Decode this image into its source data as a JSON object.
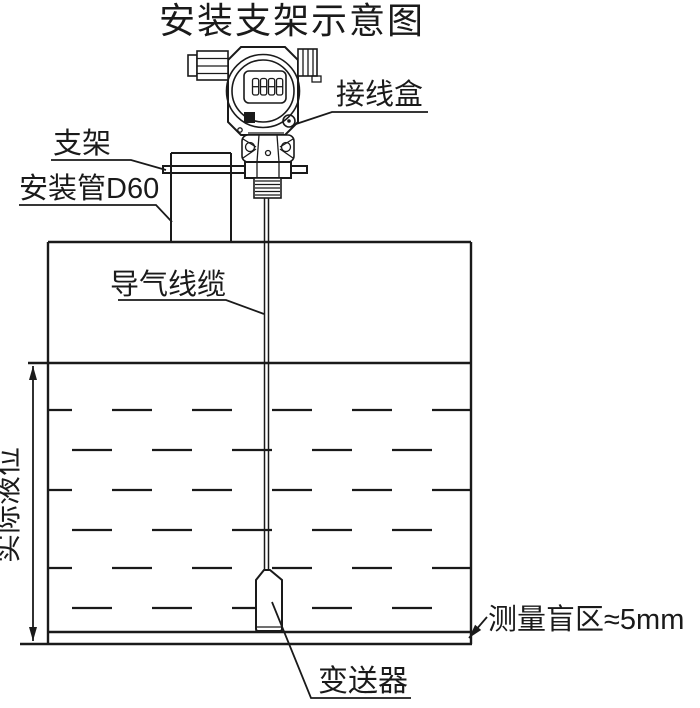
{
  "title": "安装支架示意图",
  "labels": {
    "junction_box": "接线盒",
    "bracket": "支架",
    "mounting_pipe": "安装管D60",
    "air_cable": "导气线缆",
    "actual_level": "实际液位",
    "transmitter": "变送器",
    "blind_zone": "测量盲区≈5mm"
  },
  "lcd": {
    "value": "8888"
  },
  "colors": {
    "line": "#1a1a1a",
    "background": "#ffffff"
  }
}
